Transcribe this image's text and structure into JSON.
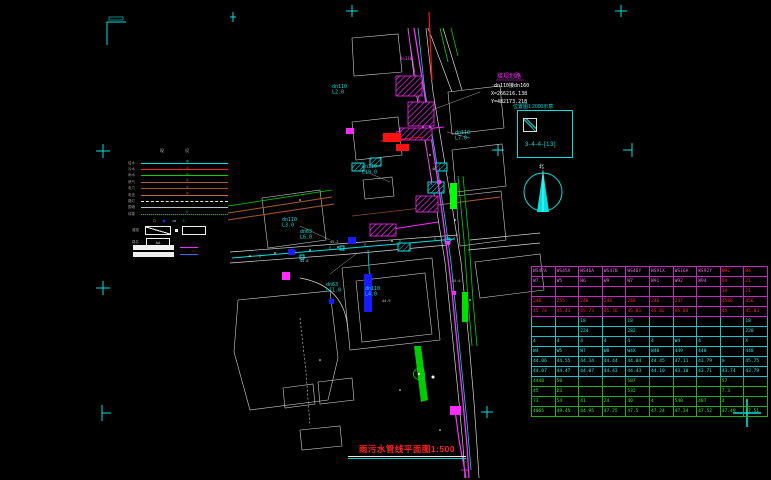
{
  "drawing": {
    "title": "雨污水管线平面图1:500",
    "coord_note": {
      "road": "接规划路",
      "pipe": "dn110接dn160",
      "x": "X=266216.138",
      "y": "Y=482173.218"
    },
    "index_box": {
      "title": "位置图1:2000示意",
      "code": "3-4-4-[13]"
    },
    "north_label": "北"
  },
  "legend": {
    "headers": [
      "现",
      "设"
    ],
    "rows": [
      {
        "label": "给水",
        "color": "#00e0e0",
        "style": "solid",
        "marker": "φ"
      },
      {
        "label": "污水",
        "color": "#ff2222",
        "style": "solid",
        "marker": "φ"
      },
      {
        "label": "雨水",
        "color": "#00d400",
        "style": "solid",
        "marker": "φ"
      },
      {
        "label": "燃气",
        "color": "#b05c30",
        "style": "solid",
        "marker": "φ"
      },
      {
        "label": "电力",
        "color": "#a85428",
        "style": "solid",
        "marker": "φ"
      },
      {
        "label": "电信",
        "color": "#c06838",
        "style": "solid",
        "marker": "φ"
      },
      {
        "label": "路灯",
        "color": "#e8e8e8",
        "style": "dashed",
        "marker": ""
      },
      {
        "label": "围墙",
        "color": "#bdbdbd",
        "style": "solid",
        "marker": ""
      },
      {
        "label": "绿篱",
        "color": "#00d400",
        "style": "dotted",
        "marker": "£"
      }
    ],
    "symbols": [
      {
        "glyph": "—",
        "color": "#2a2aff"
      },
      {
        "glyph": "□",
        "color": "#ffffff"
      },
      {
        "glyph": "◆",
        "color": "#2a2aff"
      },
      {
        "glyph": "▭",
        "color": "#ffffff"
      },
      {
        "glyph": "Ł",
        "color": "#00d400"
      }
    ],
    "slash_label": "道路",
    "name_label": "路名",
    "name_box_text": "AA"
  },
  "map": {
    "labels": [
      {
        "x": 332,
        "y": 88,
        "color": "#00e0e0",
        "size": 5,
        "lines": [
          "dn110",
          "L2.0"
        ]
      },
      {
        "x": 455,
        "y": 134,
        "color": "#00e0e0",
        "size": 5,
        "lines": [
          "dn110",
          "L7.0"
        ]
      },
      {
        "x": 362,
        "y": 168,
        "color": "#00e0e0",
        "size": 5,
        "lines": [
          "dn110",
          "L19.0"
        ]
      },
      {
        "x": 282,
        "y": 221,
        "color": "#00e0e0",
        "size": 5,
        "lines": [
          "dn110",
          "L3.0"
        ]
      },
      {
        "x": 300,
        "y": 233,
        "color": "#00e0e0",
        "size": 5,
        "lines": [
          "dn63",
          "L6.0"
        ]
      },
      {
        "x": 326,
        "y": 286,
        "color": "#00e0e0",
        "size": 5,
        "lines": [
          "dn63",
          "L11.0"
        ]
      },
      {
        "x": 365,
        "y": 290,
        "color": "#00e0e0",
        "size": 5,
        "lines": [
          "dn110",
          "L4.0"
        ]
      },
      {
        "x": 400,
        "y": 60,
        "color": "#ff44ff",
        "size": 4,
        "lines": [
          "dn110"
        ]
      },
      {
        "x": 330,
        "y": 243,
        "color": "#cccccc",
        "size": 3.5,
        "lines": [
          "45.2"
        ]
      },
      {
        "x": 300,
        "y": 262,
        "color": "#cccccc",
        "size": 3.5,
        "lines": [
          "44.8"
        ]
      },
      {
        "x": 432,
        "y": 170,
        "color": "#cccccc",
        "size": 3.5,
        "lines": [
          "46.1"
        ]
      },
      {
        "x": 452,
        "y": 282,
        "color": "#cccccc",
        "size": 3.5,
        "lines": [
          "45.6"
        ]
      },
      {
        "x": 382,
        "y": 302,
        "color": "#cccccc",
        "size": 3.5,
        "lines": [
          "44.9"
        ]
      }
    ]
  },
  "table": {
    "rows": [
      {
        "border": "#c726c7",
        "color": "#e86ee8",
        "cells": [
          "WS47A",
          "WS45A",
          "WS46A",
          "WS47B",
          "WS46Y",
          "WS91X",
          "WS16A",
          "WS92Y",
          {
            "t": "W92",
            "c": "#ff2a2a"
          },
          {
            "t": "B4",
            "c": "#ff2a2a"
          }
        ]
      },
      {
        "border": "#c726c7",
        "color": "#e86ee8",
        "cells": [
          "W7",
          "W5",
          "W6",
          "W9",
          "W7",
          "W91",
          "W92",
          "W94",
          {
            "t": "94",
            "c": "#ff2a2a"
          },
          {
            "t": "21",
            "c": "#ff2a2a"
          }
        ]
      },
      {
        "border": "#c726c7",
        "color": "#e86ee8",
        "cells": [
          "",
          "",
          "",
          "",
          "",
          "",
          "",
          "",
          {
            "t": "34",
            "c": "#ff2a2a"
          },
          {
            "t": "21",
            "c": "#ff2a2a"
          }
        ]
      },
      {
        "border": "#c726c7",
        "color": "#ff2a2a",
        "cells": [
          "246",
          "255",
          "248",
          "246",
          "248",
          "246",
          "247",
          "",
          "4586",
          "456"
        ]
      },
      {
        "border": "#c726c7",
        "color": "#ff2a2a",
        "cells": [
          "45.74",
          "45.43",
          "45.73",
          "45.76",
          "45.81",
          "45.82",
          "45.04",
          "",
          "45",
          "45.03"
        ]
      },
      {
        "border": "#18c5c5",
        "color": "#2ee8e8",
        "cells": [
          "",
          "",
          "18",
          "",
          "18",
          "",
          "",
          "",
          "",
          "18"
        ]
      },
      {
        "border": "#18c5c5",
        "color": "#2ee8e8",
        "cells": [
          "",
          "",
          "224",
          "",
          "282",
          "",
          "",
          "",
          "",
          "228"
        ]
      },
      {
        "border": "#18c5c5",
        "color": "#2ee8e8",
        "cells": [
          "4",
          "4",
          "4",
          "4",
          "4",
          "4",
          "W4",
          "4",
          "",
          "X"
        ]
      },
      {
        "border": "#18c5c5",
        "color": "#2ee8e8",
        "cells": [
          "W4",
          "W5",
          "W7",
          "W8",
          "W4X",
          "W48",
          "449",
          "448",
          "",
          "448"
        ]
      },
      {
        "border": "#18c5c5",
        "color": "#2ee8e8",
        "cells": [
          "44.06",
          "44.55",
          "44.34",
          "44.44",
          "44.04",
          "44.45",
          "47.11",
          "43.79",
          "m",
          "45.75"
        ]
      },
      {
        "border": "#18c5c5",
        "color": "#2ee8e8",
        "cells": [
          "44.07",
          "44.47",
          "44.07",
          "44.43",
          "44.43",
          "44.10",
          "43.10",
          "43.71",
          "43.74",
          "43.79"
        ]
      },
      {
        "border": "#1faf1f",
        "color": "#35e835",
        "cells": [
          "4448",
          "50",
          "",
          "",
          "587",
          "",
          "",
          "",
          "57",
          ""
        ]
      },
      {
        "border": "#1faf1f",
        "color": "#35e835",
        "cells": [
          "45",
          "D3",
          "",
          "",
          "532",
          "",
          "",
          "",
          "7.3",
          ""
        ]
      },
      {
        "border": "#1faf1f",
        "color": "#35e835",
        "cells": [
          "73",
          "54",
          "41",
          "24",
          "40",
          "4",
          "540",
          "487",
          "4",
          "4"
        ]
      },
      {
        "border": "#1faf1f",
        "color": "#35e835",
        "cells": [
          "4065",
          "49.45",
          "44.95",
          "47.25",
          "47.5",
          "47.24",
          "47.34",
          "47.52",
          "47.49",
          "47.51"
        ]
      }
    ]
  }
}
